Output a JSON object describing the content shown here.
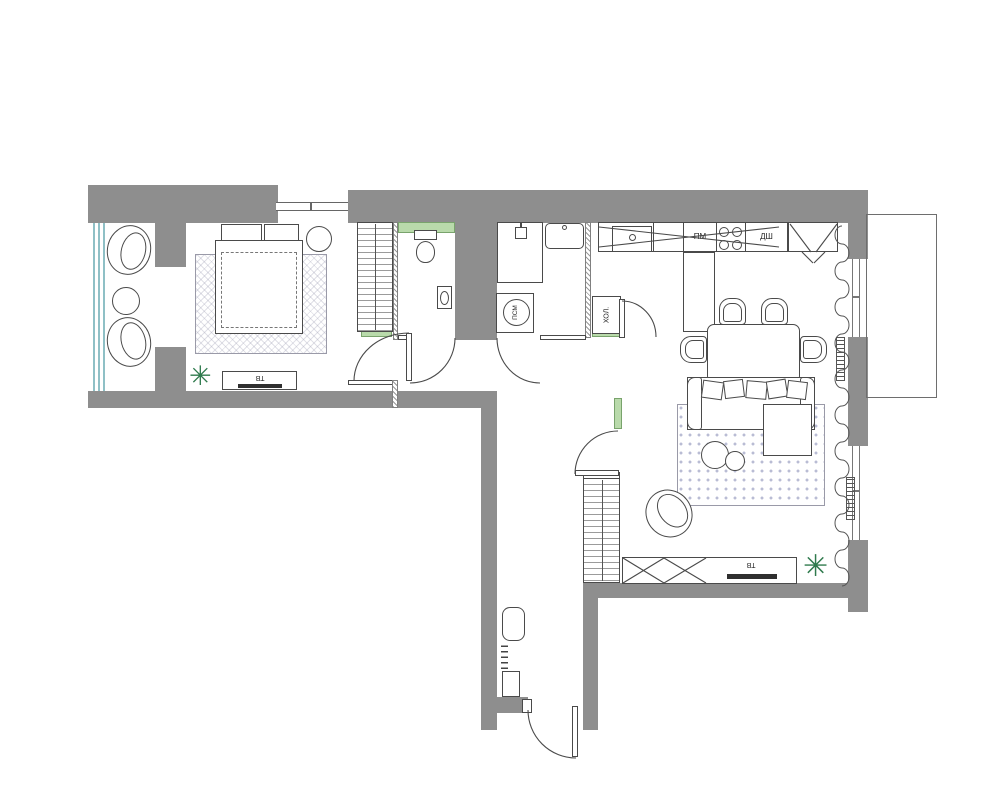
{
  "title": "Apartment floor plan",
  "colors": {
    "wall_gray": "#8e8e8e",
    "accent_green": "#b9daab",
    "window_teal": "#8fc0c6",
    "furniture_outline": "#4a4a4a",
    "rug_living_dot": "#b9bcd4",
    "plant_green": "#2f7a4d",
    "tv_dark": "#2f2f2f"
  },
  "labels": {
    "washing_machine": "ПСМ",
    "fridge": "ХОЛ.",
    "dishwasher": "ПМ",
    "oven_cabinet": "ДШ",
    "tv_bedroom": "ТВ",
    "tv_living": "ТВ"
  },
  "icons": {
    "plant": "✳"
  }
}
